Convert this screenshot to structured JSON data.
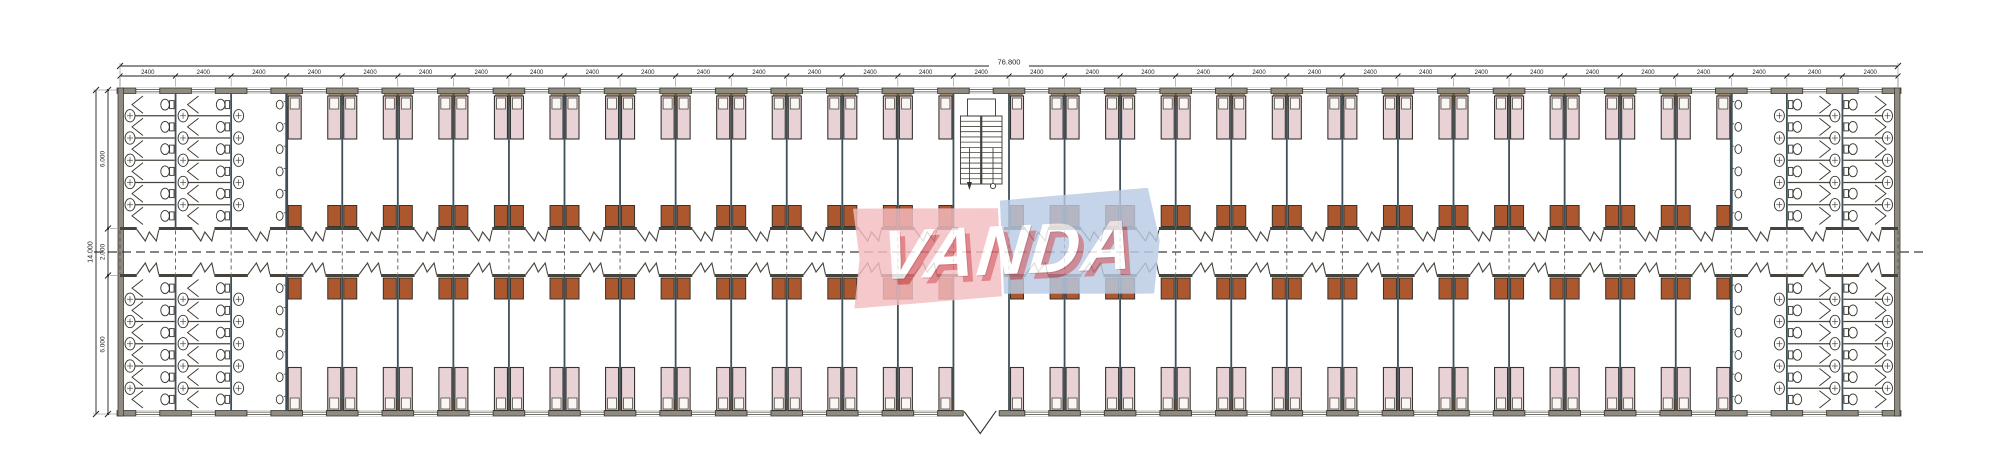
{
  "watermark": {
    "text": "VANDA",
    "colors": {
      "pink": "#f4bcc1",
      "red": "#cf3a40",
      "blue": "#b9cbe3",
      "dark_blue": "#2d4f9e"
    }
  },
  "dimensions": {
    "top": {
      "overall_label": "76.800",
      "bay_label": "2400",
      "bay_count": 32
    },
    "left": {
      "overall_label": "14.000",
      "segment_labels": [
        "6.000",
        "2.000",
        "6.000"
      ]
    }
  },
  "plan": {
    "type": "dormitory-floor-plan",
    "bays_total": 32,
    "left_sanitary_bays": 3,
    "right_sanitary_bays": 3,
    "stair_bay": 16,
    "entrance_bay": 16,
    "rooms_top_row": 25,
    "rooms_bottom_row": 25,
    "beds_per_room": 2,
    "cabinets_per_room": 2,
    "toilet_stalls_per_column": 6,
    "basins_per_column": 5,
    "urinals_per_column": 6
  },
  "colors": {
    "wall_fill": "#8f8b80",
    "wall_edge": "#3e3d36",
    "line": "#45443c",
    "stroke": "#35342e",
    "bed_fill": "#e9d2d6",
    "pillow": "#faf6f3",
    "headboard": "#b5a285",
    "headboard_edge": "#6b5d45",
    "cabinet": "#ad572f",
    "dash": "#3c3c3c",
    "dim": "#1f1f1f"
  }
}
